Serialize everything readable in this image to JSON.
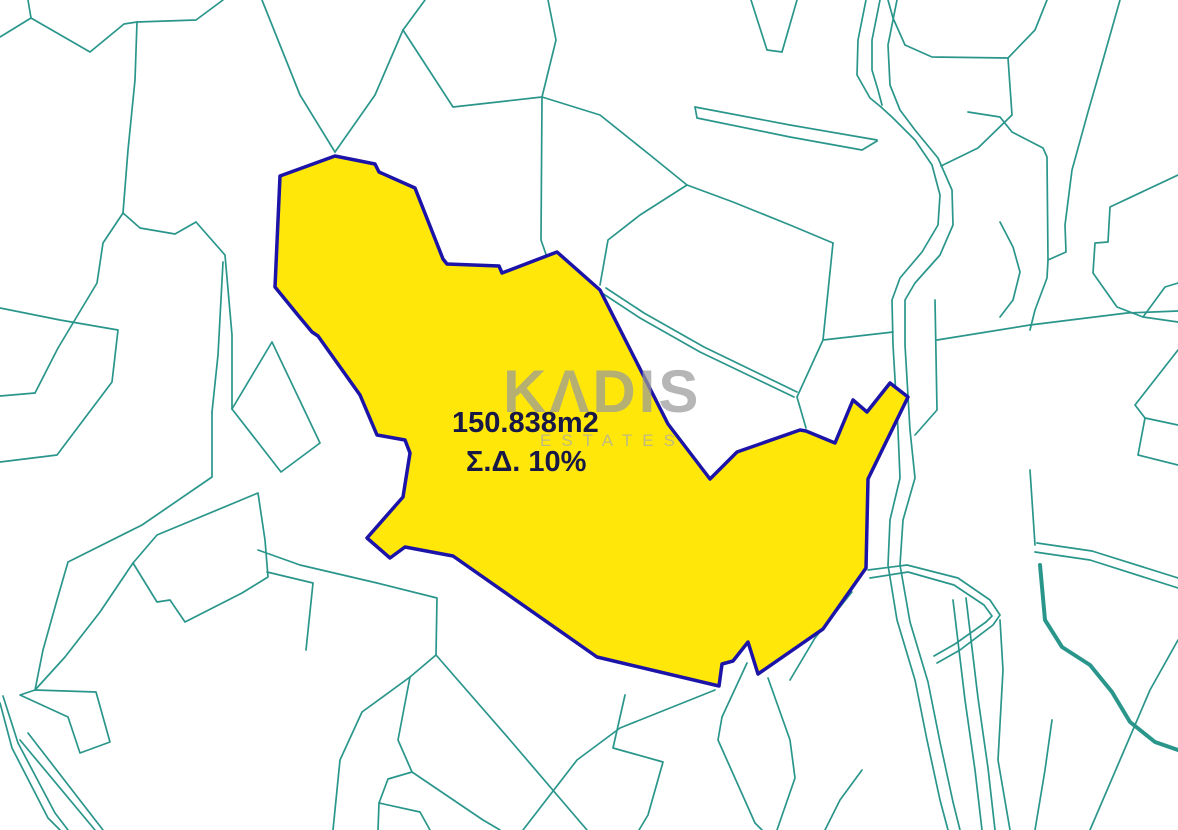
{
  "map": {
    "background": "#ffffff",
    "colors": {
      "boundary_lines": "#2a968b",
      "parcel_fill": "#ffe70a",
      "parcel_stroke": "#1c13a8",
      "label_text": "#181847",
      "watermark_primary": "#9a9a9a",
      "watermark_secondary": "#ababab"
    },
    "stroke": {
      "thin": 1.7,
      "thick": 4,
      "parcel": 3.5
    },
    "highlight_parcel": {
      "area_label": "150.838m2",
      "density_label": "Σ.Δ. 10%",
      "points": "280,176 335,156 375,164 379,172 415,188 443,259 447,264 499,266 502,273 557,252 600,290 668,424 710,479 737,452 800,430 806,431 835,443 853,400 867,412 890,383 908,397 868,479 866,568 823,629 758,674 748,642 733,661 722,664 719,686 597,657 453,556 405,547 390,558 367,538 403,497 410,453 405,440 377,435 360,395 318,336 312,332 297,314 275,287"
    },
    "watermark": {
      "line1": "KΛDIS",
      "line2": "ESTATES"
    },
    "lines": [
      {
        "d": "M28,0 L31,18 L90,52 L124,24 L137,22 L196,20 L223,0"
      },
      {
        "d": "M0,37 L31,18"
      },
      {
        "d": "M137,22 L135,80 L128,150 L123,213"
      },
      {
        "d": "M123,213 L103,243 L97,283 L58,348 L35,393"
      },
      {
        "d": "M35,393 L0,396"
      },
      {
        "d": "M0,308 L60,320 L118,330 L112,382 L57,455 L0,462"
      },
      {
        "d": "M123,213 L140,228 L175,234 L196,222"
      },
      {
        "d": "M196,222 L225,255 L232,335 L232,409"
      },
      {
        "d": "M232,409 L272,342 L320,443 L281,472 L232,409"
      },
      {
        "d": "M212,412 L212,477 L142,525 L68,562 L57,600 L43,650 L35,690"
      },
      {
        "d": "M212,412 L218,355 L223,262"
      },
      {
        "d": "M133,563 L157,535 L258,493 L265,540 L268,577 L242,593 L185,622 L170,600 L157,602 Z"
      },
      {
        "d": "M133,563 L100,612 L65,657 L35,690"
      },
      {
        "d": "M20,695 L68,717 L80,753 L110,742 L96,692 L35,690 Z"
      },
      {
        "d": "M258,550 L300,565 L377,583 L437,598 L436,655 L410,677 L362,712 L340,760 L333,830"
      },
      {
        "d": "M267,572 L313,583 L306,650"
      },
      {
        "d": "M436,655 L510,740 L587,830"
      },
      {
        "d": "M715,690 L620,728 L577,760 L523,830"
      },
      {
        "d": "M410,677 L398,740 L412,772 L483,820 L500,830"
      },
      {
        "d": "M412,772 L388,779 L379,803 L378,830"
      },
      {
        "d": "M379,803 L420,812 L430,830"
      },
      {
        "d": "M747,663 L722,717 L718,740 L755,823 L762,830"
      },
      {
        "d": "M768,678 L790,740 L795,778 L777,830"
      },
      {
        "d": "M625,695 L613,748 L663,762 L648,815 L639,830"
      },
      {
        "d": "M335,152 L375,95 L403,30"
      },
      {
        "d": "M403,30 L425,0"
      },
      {
        "d": "M262,0 L300,95 L335,152"
      },
      {
        "d": "M403,30 L453,107 L542,97 L556,40 L548,0"
      },
      {
        "d": "M542,97 L541,240 L549,263"
      },
      {
        "d": "M542,97 L600,115 L650,155 L687,185"
      },
      {
        "d": "M687,185 L733,202 L790,225 L833,243"
      },
      {
        "d": "M687,185 L640,215 L608,240 L600,285"
      },
      {
        "d": "M833,243 L823,340 L797,397"
      },
      {
        "d": "M823,340 L893,332"
      },
      {
        "d": "M797,397 L806,428"
      },
      {
        "d": "M695,107 L790,125 L877,140"
      },
      {
        "d": "M695,107 L697,118 L790,137 L862,150 L877,141"
      },
      {
        "d": "M751,0 L767,50 L782,52 L797,0"
      },
      {
        "d": "M905,45 L893,18 L888,0"
      },
      {
        "d": "M905,45 L932,57 L1008,58 L1012,115 L978,148 L941,166"
      },
      {
        "d": "M1008,58 L1035,30 L1047,0"
      },
      {
        "d": "M1120,0 L1103,60 L1088,112 L1072,170 L1065,225 L1066,252 L1048,260 L1047,278 L1035,310 L1030,330"
      },
      {
        "d": "M968,112 L1000,117 L1012,132 L1043,148 L1047,157 L1048,260"
      },
      {
        "d": "M1000,222 L1013,247 L1020,272 L1013,300 L1000,317"
      },
      {
        "d": "M937,340 L1030,325 L1127,313 L1178,311"
      },
      {
        "d": "M1178,175 L1110,207 L1108,242 L1095,243 L1093,273 L1117,307 L1143,317 L1165,287 L1178,283"
      },
      {
        "d": "M1143,317 L1178,322"
      },
      {
        "d": "M1178,350 L1135,405 L1145,418 L1178,425"
      },
      {
        "d": "M1145,418 L1138,455 L1178,465"
      },
      {
        "d": "M935,300 L937,410 L915,435"
      },
      {
        "d": "M1030,470 L1035,545"
      },
      {
        "d": "M1035,552 L1090,560 L1178,588"
      },
      {
        "d": "M1037,543 L1092,551 L1178,578"
      },
      {
        "d": "M852,592 L815,638 L790,680"
      },
      {
        "d": "M868,570 L907,565 L958,578 L990,600 L1000,615 L993,625 L960,650 L937,663"
      },
      {
        "d": "M870,578 L908,572 L954,585 L984,605 L992,616 L986,622 L955,644 L934,656"
      },
      {
        "d": "M953,600 L965,700 L975,770 L982,830"
      },
      {
        "d": "M966,598 L978,698 L988,768 L995,830"
      },
      {
        "d": "M1000,620 L1003,670 L998,760 L1010,830"
      },
      {
        "d": "M1090,830 L1120,760 L1150,690 L1178,640"
      },
      {
        "d": "M1035,830 L1045,770 L1052,720"
      },
      {
        "d": "M862,770 L840,800 L825,830"
      },
      {
        "d": "M602,293 L640,318 L700,352 L794,397"
      },
      {
        "d": "M606,288 L644,313 L704,347 L797,392"
      },
      {
        "d": "M3,696 L18,743 L55,813 L68,830"
      },
      {
        "d": "M0,703 L12,748 L48,818 L60,830"
      },
      {
        "d": "M20,740 L95,830"
      },
      {
        "d": "M28,733 L103,830"
      },
      {
        "d": "M866,0 L858,40 L857,75 L870,98 L881,107"
      },
      {
        "d": "M880,0 L872,40 L872,70 L878,90 L882,105"
      },
      {
        "d": "M881,107 L893,118 L915,140 L932,165 L940,195 L938,225 L922,252 L900,278 L892,300 L893,345 L898,430 L900,478 L890,520 L888,565 L897,620 L915,680 L927,740 L940,800 L948,830"
      },
      {
        "d": "M897,0 L888,45 L890,85 L900,110 L915,130 L938,158 L952,190 L953,225 L940,255 L915,283 L905,300 L905,345 L910,430 L915,478 L903,520 L900,565 L910,622 L928,682 L940,742 L953,802 L960,830"
      },
      {
        "d": "M1040,565 L1045,620 L1062,647 L1090,665 L1112,692 L1130,722 L1155,742 L1178,750",
        "w": 4
      }
    ]
  }
}
